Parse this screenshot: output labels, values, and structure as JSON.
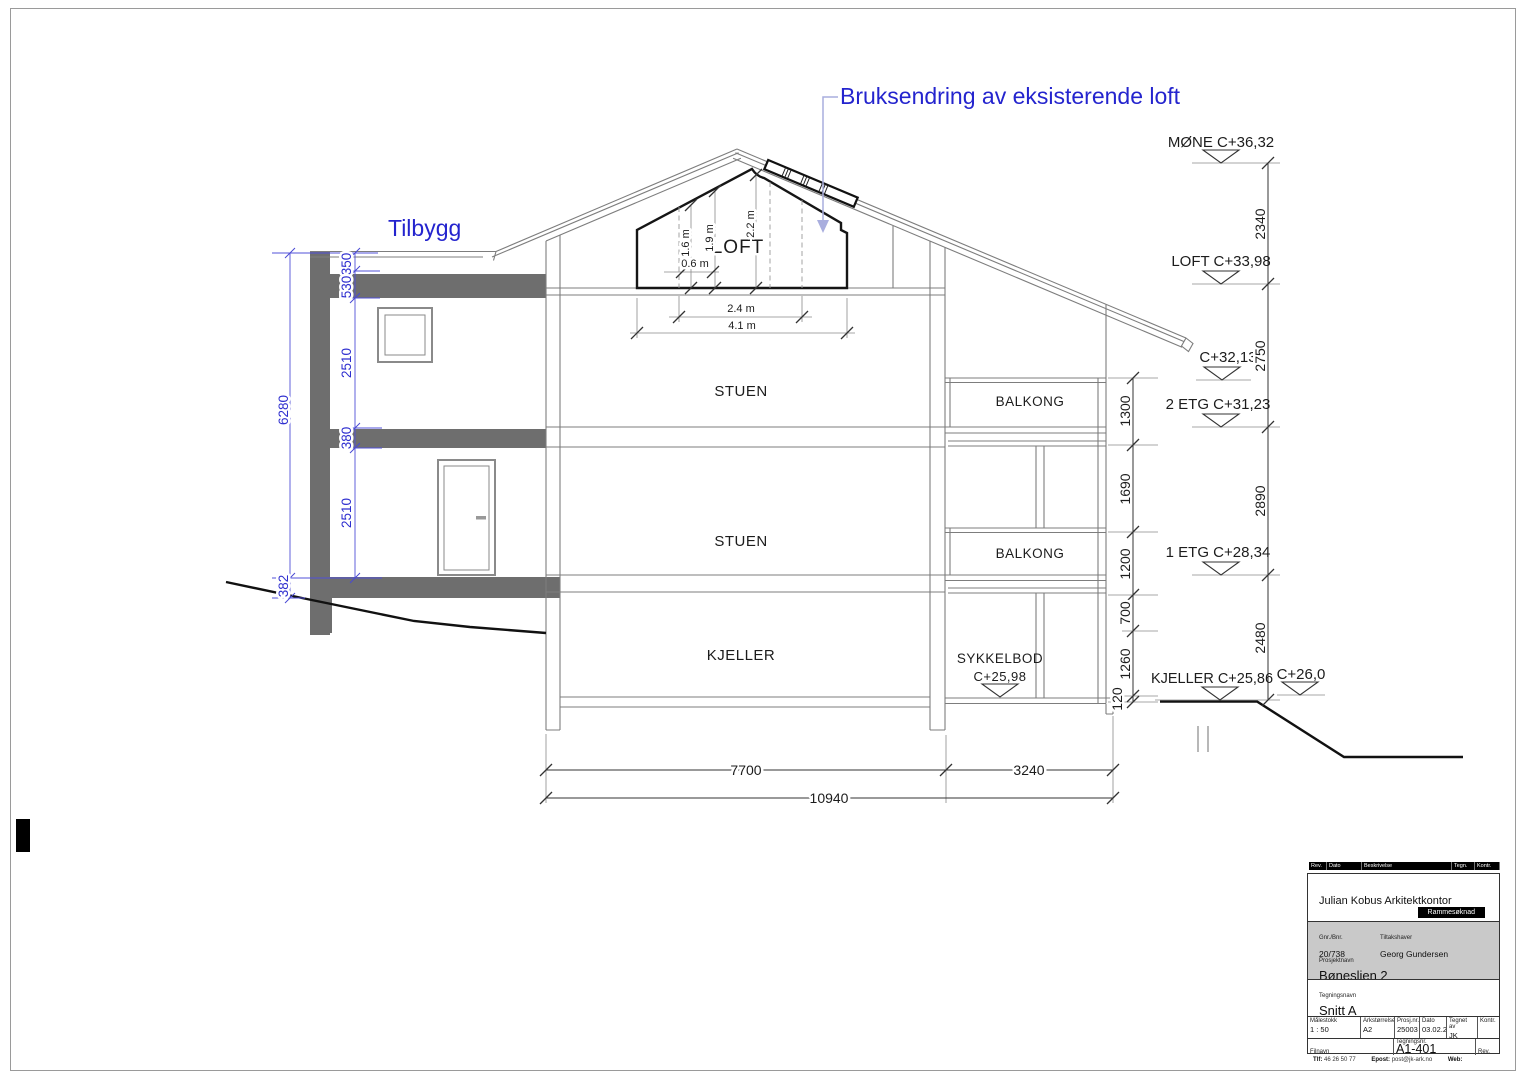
{
  "annotations": {
    "loft_change": "Bruksendring av eksisterende loft",
    "tilbygg": "Tilbygg"
  },
  "rooms": {
    "loft": "LOFT",
    "stuen_upper": "STUEN",
    "stuen_lower": "STUEN",
    "kjeller": "KJELLER",
    "balkong_upper": "BALKONG",
    "balkong_lower": "BALKONG",
    "sykkelbod": "SYKKELBOD",
    "sykkelbod_level": "C+25,98"
  },
  "levels": {
    "mone": "MØNE C+36,32",
    "loft": "LOFT C+33,98",
    "c32": "C+32,13",
    "etg2": "2 ETG C+31,23",
    "etg1": "1 ETG C+28,34",
    "kjeller": "KJELLER C+25,86",
    "c26": "C+26,0"
  },
  "dims": {
    "right": [
      "2340",
      "2750",
      "2890",
      "2480"
    ],
    "inner": [
      "1300",
      "1690",
      "1200",
      "700",
      "1260",
      "120"
    ],
    "left": [
      "6280",
      "350",
      "530",
      "2510",
      "380",
      "2510",
      "382"
    ],
    "bottom": [
      "7700",
      "3240",
      "10940"
    ],
    "loft": [
      "0.6 m",
      "1.6 m",
      "1.9 m",
      "2.2 m",
      "2.4 m",
      "4.1 m"
    ]
  },
  "titleblock": {
    "rev_header": {
      "rev": "Rev.",
      "dato": "Dato",
      "beskrivelse": "Beskrivelse",
      "tegn": "Tegn.",
      "kontr": "Kontr."
    },
    "company": "Julian Kobus Arkitektkontor",
    "badge": "Rammesøknad",
    "gnr_label": "Gnr./Bnr.",
    "gnr": "20/738",
    "tiltakshaver_label": "Tiltakshaver",
    "tiltakshaver": "Georg Gundersen",
    "prosjekt_label": "Prosjektnavn",
    "prosjekt": "Bøneslien 2",
    "tegning_label": "Tegningsnavn",
    "tegning": "Snitt A",
    "table": {
      "malestokk_label": "Målestokk",
      "malestokk": "1 : 50",
      "ark_label": "Arkstørrelse",
      "ark": "A2",
      "prosjnr_label": "Prosj.nr.",
      "prosjnr": "25003",
      "dato_label": "Dato",
      "dato": "03.02.26",
      "tegnetav_label": "Tegnet av",
      "tegnetav": "JK",
      "kontr_label": "Kontr.",
      "kontr": ""
    },
    "filnavn_label": "Filnavn",
    "tegningsnr_label": "Tegningsnr.",
    "tegningsnr": "A1-401",
    "rev_label": "Rev.",
    "footer": {
      "tlf_label": "Tlf:",
      "tlf": "46 26 50 77",
      "epost_label": "Epost:",
      "epost": "post@jk-ark.no",
      "web_label": "Web:"
    }
  },
  "colors": {
    "annotation_blue": "#2424ce",
    "dim_blue": "#2e2ecf",
    "arrow_blue": "#a9aede",
    "slab_gray": "#6e6e6e",
    "line_gray": "#7d7d7d"
  }
}
